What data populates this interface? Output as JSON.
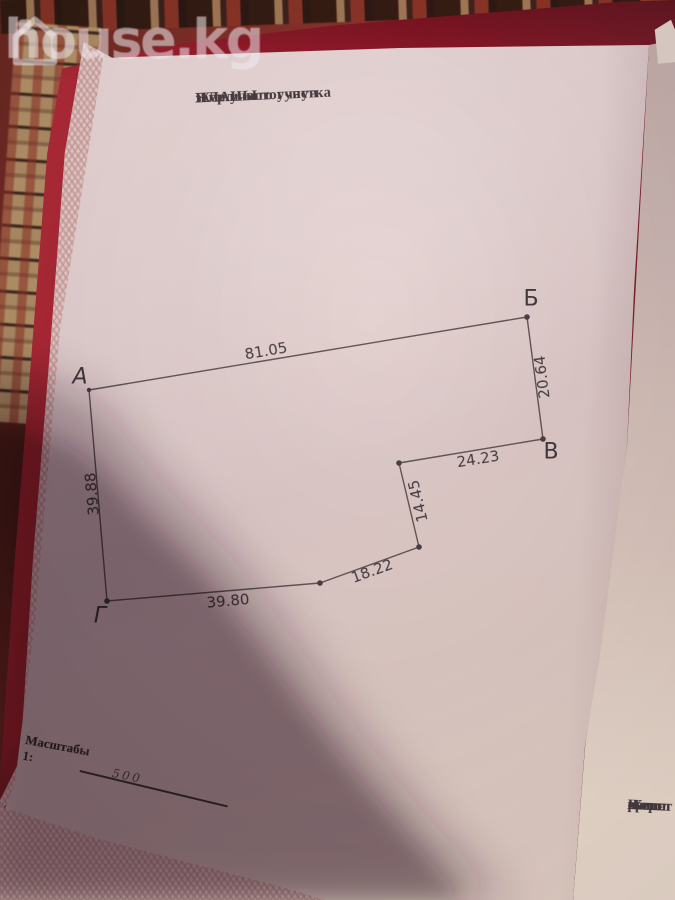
{
  "watermark": {
    "brand": "house.kg",
    "icon": "house-icon"
  },
  "page": {
    "header": {
      "line1": "Жер участогунун",
      "line2": "ПЛАНЫ",
      "line3": "ПЛАН",
      "line4": "земельного участка"
    },
    "scale": {
      "line1": "Масштабы",
      "line2": "Масштаб 1:",
      "value": "500"
    },
    "side_text": {
      "line1": "Жерг",
      "line2": "орган",
      "line3": "Испол",
      "line4": "регист"
    }
  },
  "diagram": {
    "type": "land-plot-plan",
    "vertex_labels": {
      "A": "А",
      "B": "Б",
      "V": "В",
      "G": "Г"
    },
    "side_lengths": {
      "AB": "81.05",
      "BV": "20.64",
      "VC": "24.23",
      "CD": "14.45",
      "DE": "18.22",
      "EG": "39.80",
      "GA": "39.88"
    }
  },
  "colors": {
    "folder_red": "#a51f2e",
    "paper": "#e3d1cf",
    "carpet_red": "#8a322a",
    "carpet_tan": "#b6946a",
    "ink": "#463b40"
  }
}
